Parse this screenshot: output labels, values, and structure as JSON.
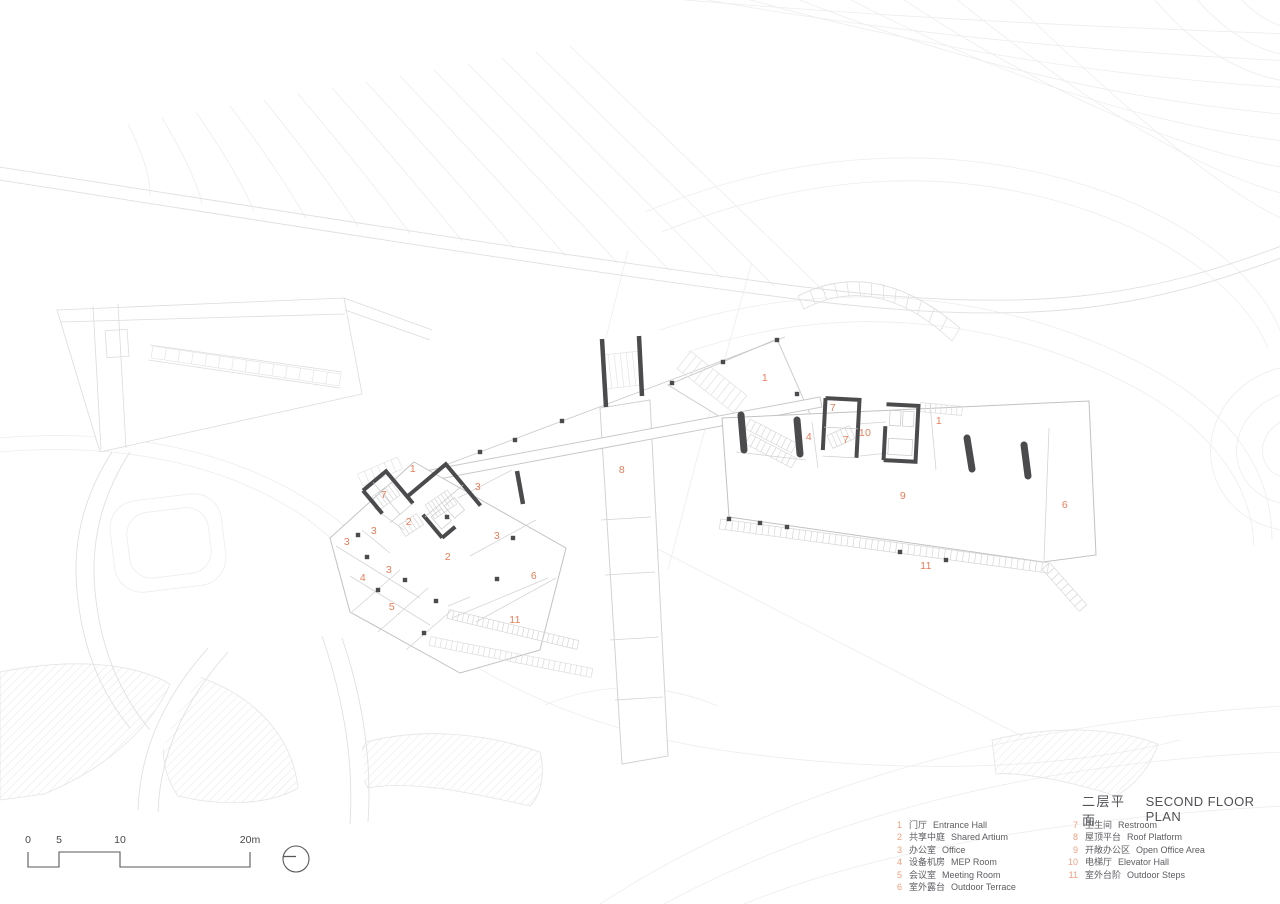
{
  "sheet": {
    "title_zh": "二层平面",
    "title_en": "SECOND FLOOR PLAN"
  },
  "legend": {
    "columns": [
      {
        "items": [
          {
            "num": "1",
            "zh": "门厅",
            "en": "Entrance Hall"
          },
          {
            "num": "2",
            "zh": "共享中庭",
            "en": "Shared Artium"
          },
          {
            "num": "3",
            "zh": "办公室",
            "en": "Office"
          },
          {
            "num": "4",
            "zh": "设备机房",
            "en": "MEP Room"
          },
          {
            "num": "5",
            "zh": "会议室",
            "en": "Meeting Room"
          },
          {
            "num": "6",
            "zh": "室外露台",
            "en": "Outdoor Terrace"
          }
        ]
      },
      {
        "items": [
          {
            "num": "7",
            "zh": "卫生间",
            "en": "Restroom"
          },
          {
            "num": "8",
            "zh": "屋顶平台",
            "en": "Roof Platform"
          },
          {
            "num": "9",
            "zh": "开敞办公区",
            "en": "Open Office Area"
          },
          {
            "num": "10",
            "zh": "电梯厅",
            "en": "Elevator Hall"
          },
          {
            "num": "11",
            "zh": "室外台阶",
            "en": "Outdoor Steps"
          }
        ]
      }
    ]
  },
  "scale_bar": {
    "labels": [
      {
        "text": "0",
        "x": 28
      },
      {
        "text": "5",
        "x": 59
      },
      {
        "text": "10",
        "x": 120
      },
      {
        "text": "20m",
        "x": 250
      }
    ]
  },
  "plan": {
    "room_numbers": [
      {
        "n": "1",
        "x": 413,
        "y": 469
      },
      {
        "n": "7",
        "x": 384,
        "y": 495
      },
      {
        "n": "3",
        "x": 478,
        "y": 487
      },
      {
        "n": "2",
        "x": 409,
        "y": 522
      },
      {
        "n": "3",
        "x": 374,
        "y": 531
      },
      {
        "n": "3",
        "x": 347,
        "y": 542
      },
      {
        "n": "3",
        "x": 497,
        "y": 536
      },
      {
        "n": "2",
        "x": 448,
        "y": 557
      },
      {
        "n": "3",
        "x": 389,
        "y": 570
      },
      {
        "n": "4",
        "x": 363,
        "y": 578
      },
      {
        "n": "5",
        "x": 392,
        "y": 607
      },
      {
        "n": "6",
        "x": 534,
        "y": 576
      },
      {
        "n": "11",
        "x": 515,
        "y": 620
      },
      {
        "n": "8",
        "x": 622,
        "y": 470
      },
      {
        "n": "1",
        "x": 765,
        "y": 378
      },
      {
        "n": "7",
        "x": 833,
        "y": 408
      },
      {
        "n": "4",
        "x": 809,
        "y": 437
      },
      {
        "n": "7",
        "x": 846,
        "y": 440
      },
      {
        "n": "10",
        "x": 865,
        "y": 433
      },
      {
        "n": "1",
        "x": 939,
        "y": 421
      },
      {
        "n": "9",
        "x": 903,
        "y": 496
      },
      {
        "n": "6",
        "x": 1065,
        "y": 505
      },
      {
        "n": "11",
        "x": 926,
        "y": 566
      }
    ]
  },
  "colors": {
    "room_number": "#E87E58",
    "legend_number": "#F0A080",
    "text_dark": "#515256",
    "wall_dark": "#4B4B4D",
    "building_outline": "#C2C2C2",
    "contour": "#ECECEC"
  }
}
